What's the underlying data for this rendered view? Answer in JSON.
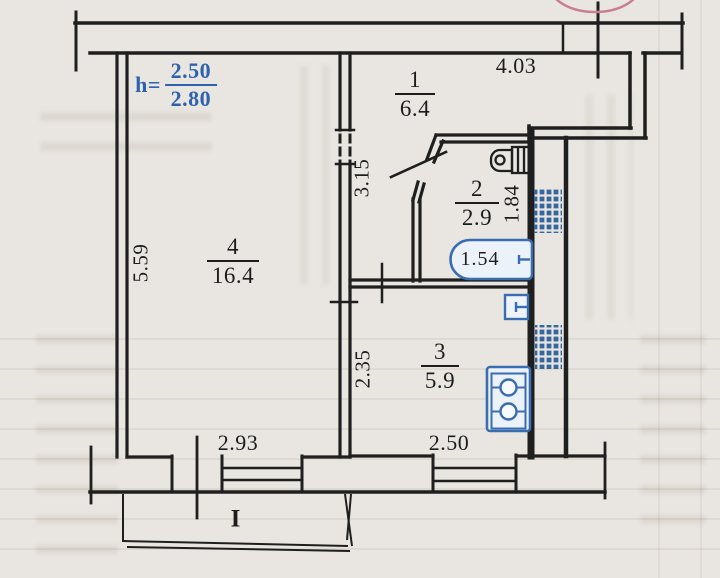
{
  "plan": {
    "height_note": {
      "label": "h=",
      "numerator": "2.50",
      "denominator": "2.80"
    },
    "rooms": {
      "hall": {
        "number": "1",
        "area": "6.4"
      },
      "bathroom": {
        "number": "2",
        "area": "2.9"
      },
      "kitchen": {
        "number": "3",
        "area": "5.9"
      },
      "living": {
        "number": "4",
        "area": "16.4"
      }
    },
    "dimensions": {
      "hall_width": "4.03",
      "hall_depth": "3.15",
      "bathroom_depth": "1.84",
      "bathtub_length": "1.54",
      "living_depth": "5.59",
      "kitchen_depth": "2.35",
      "living_width": "2.93",
      "kitchen_width": "2.50"
    },
    "balcony_label": "I",
    "fixtures": [
      "bathtub",
      "toilet",
      "kitchen-sink",
      "stove",
      "vent-duct",
      "vent-duct"
    ],
    "colors": {
      "fixture_blue": "#3a6cb0",
      "note_blue": "#2d63ae",
      "linework": "#1f1f1f",
      "stamp_pink": "#c8808e",
      "paper": "#e9e6e1"
    }
  }
}
